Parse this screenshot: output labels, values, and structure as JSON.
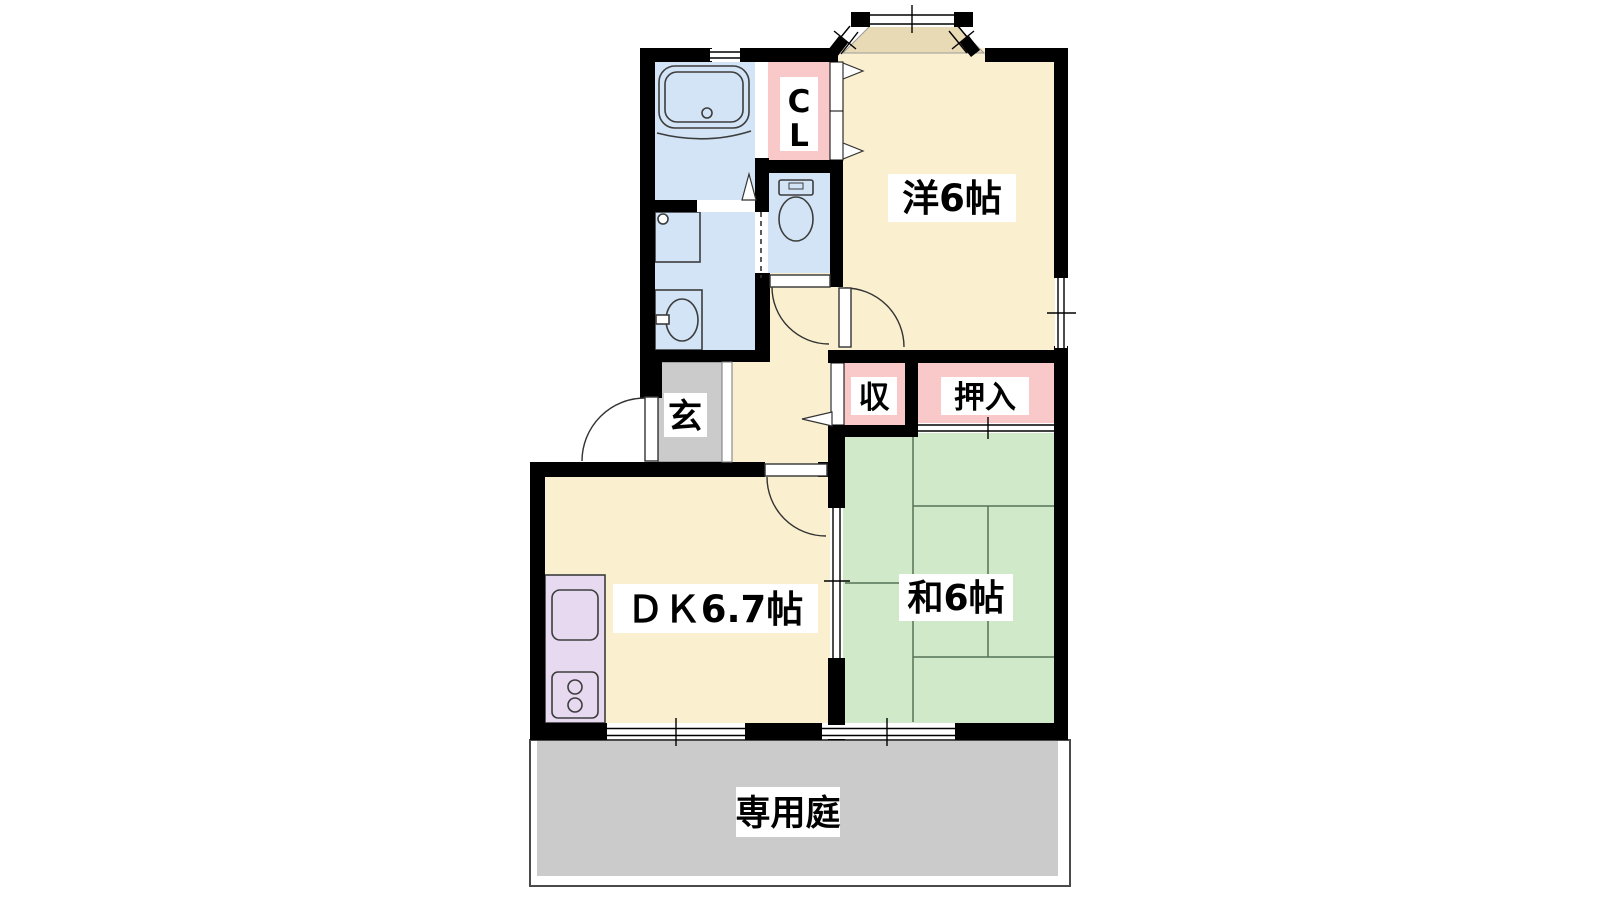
{
  "plan": {
    "type": "japanese-apartment-floorplan",
    "labels": {
      "western_room": "洋6帖",
      "closet_c": "C",
      "closet_l": "L",
      "entrance": "玄",
      "storage": "収",
      "oshiire": "押入",
      "japanese_room": "和6帖",
      "dining_kitchen": "ＤＫ6.7帖",
      "private_garden": "専用庭"
    },
    "colors": {
      "wall": "#000000",
      "cream": "#faf0d0",
      "bay": "#e9dab6",
      "blue": "#d2e4f5",
      "pink": "#f9c8c9",
      "green": "#cfe9c9",
      "tatami_line": "#567255",
      "gray": "#cbcbcb",
      "lavender": "#e6d9f0",
      "label_bg": "#ffffff",
      "fixture_stroke": "#3d3d3d"
    },
    "fixtures": [
      "bathtub",
      "washing-machine-pan",
      "washbasin",
      "toilet",
      "kitchen-counter",
      "kitchen-sink",
      "gas-stove"
    ],
    "openings": [
      "entrance-door",
      "toilet-door",
      "western-room-door",
      "dk-door",
      "bay-window",
      "side-window",
      "bath-window",
      "closet-doors",
      "storage-door",
      "oshiire-sliding-door",
      "dk-washitsu-sliding-door",
      "terrace-window-left",
      "terrace-window-right"
    ]
  }
}
